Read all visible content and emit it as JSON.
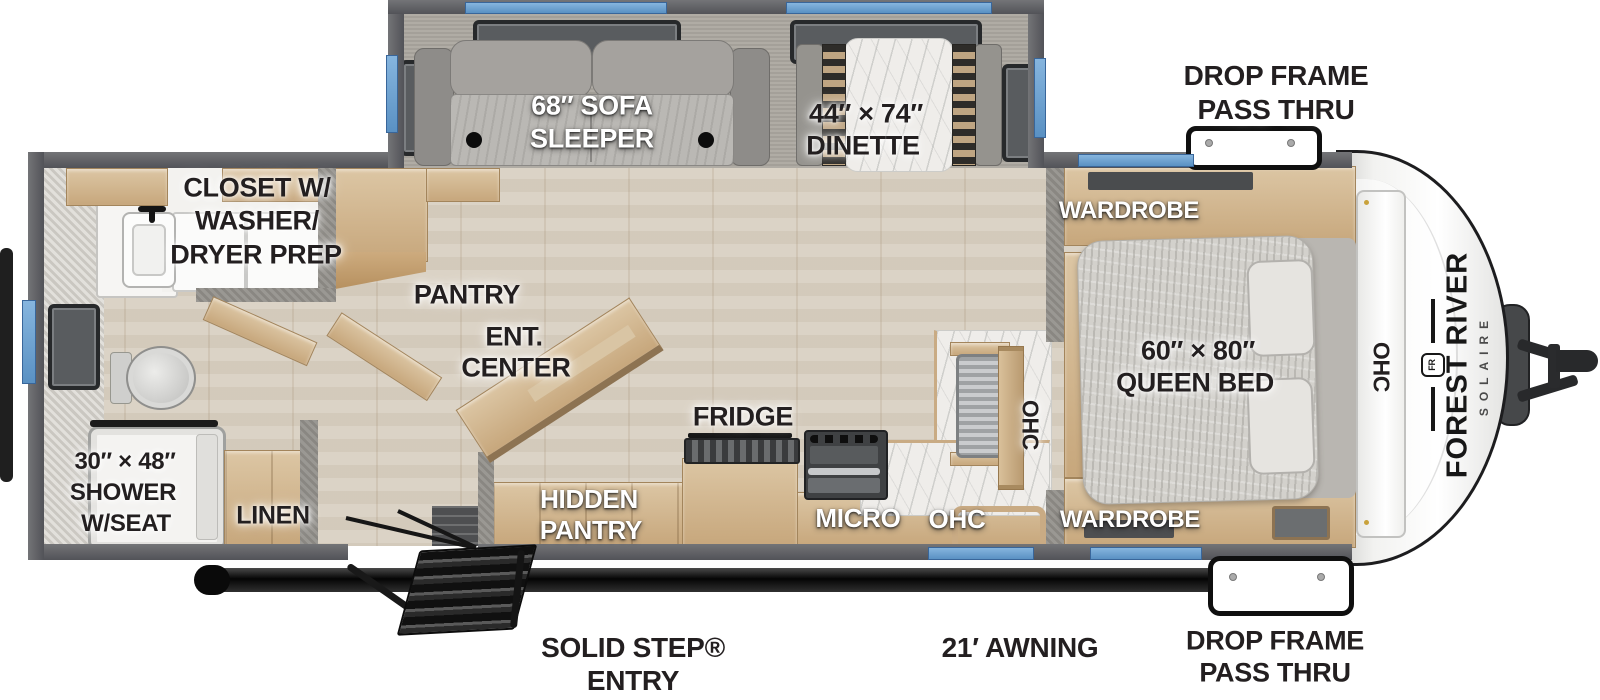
{
  "brand": {
    "line1": "FOREST RIVER",
    "line2": "SOLAIRE",
    "logo_text": "FR"
  },
  "labels": {
    "drop_frame_top": {
      "l1": "DROP FRAME",
      "l2": "PASS THRU"
    },
    "drop_frame_bottom": {
      "l1": "DROP FRAME",
      "l2": "PASS THRU"
    },
    "sofa": {
      "l1": "68″ SOFA",
      "l2": "SLEEPER"
    },
    "dinette": {
      "l1": "44″ × 74″",
      "l2": "DINETTE"
    },
    "closet": {
      "l1": "CLOSET W/",
      "l2": "WASHER/",
      "l3": "DRYER PREP"
    },
    "wardrobe_top": "WARDROBE",
    "wardrobe_bottom": "WARDROBE",
    "queen_bed": {
      "l1": "60″ × 80″",
      "l2": "QUEEN BED"
    },
    "ohc_bedroom": "OHC",
    "ohc_kitchen_wall": "OHC",
    "ohc_kitchen_lower": "OHC",
    "pantry": "PANTRY",
    "ent_center": {
      "l1": "ENT.",
      "l2": "CENTER"
    },
    "fridge": "FRIDGE",
    "hidden_pantry": {
      "l1": "HIDDEN",
      "l2": "PANTRY"
    },
    "micro": "MICRO",
    "linen": "LINEN",
    "shower": {
      "l1": "30″ × 48″",
      "l2": "SHOWER",
      "l3": "W/SEAT"
    },
    "solid_step": {
      "l1": "SOLID STEP®",
      "l2": "ENTRY"
    },
    "awning": "21′ AWNING"
  },
  "colors": {
    "window_blue": "#6fa7d8",
    "wall_gray": "#5d5e60",
    "cabinet_tan": "#d3b791",
    "floor_wood": "#d9d0c2",
    "label_black": "#231f20",
    "label_white": "#ffffff"
  }
}
